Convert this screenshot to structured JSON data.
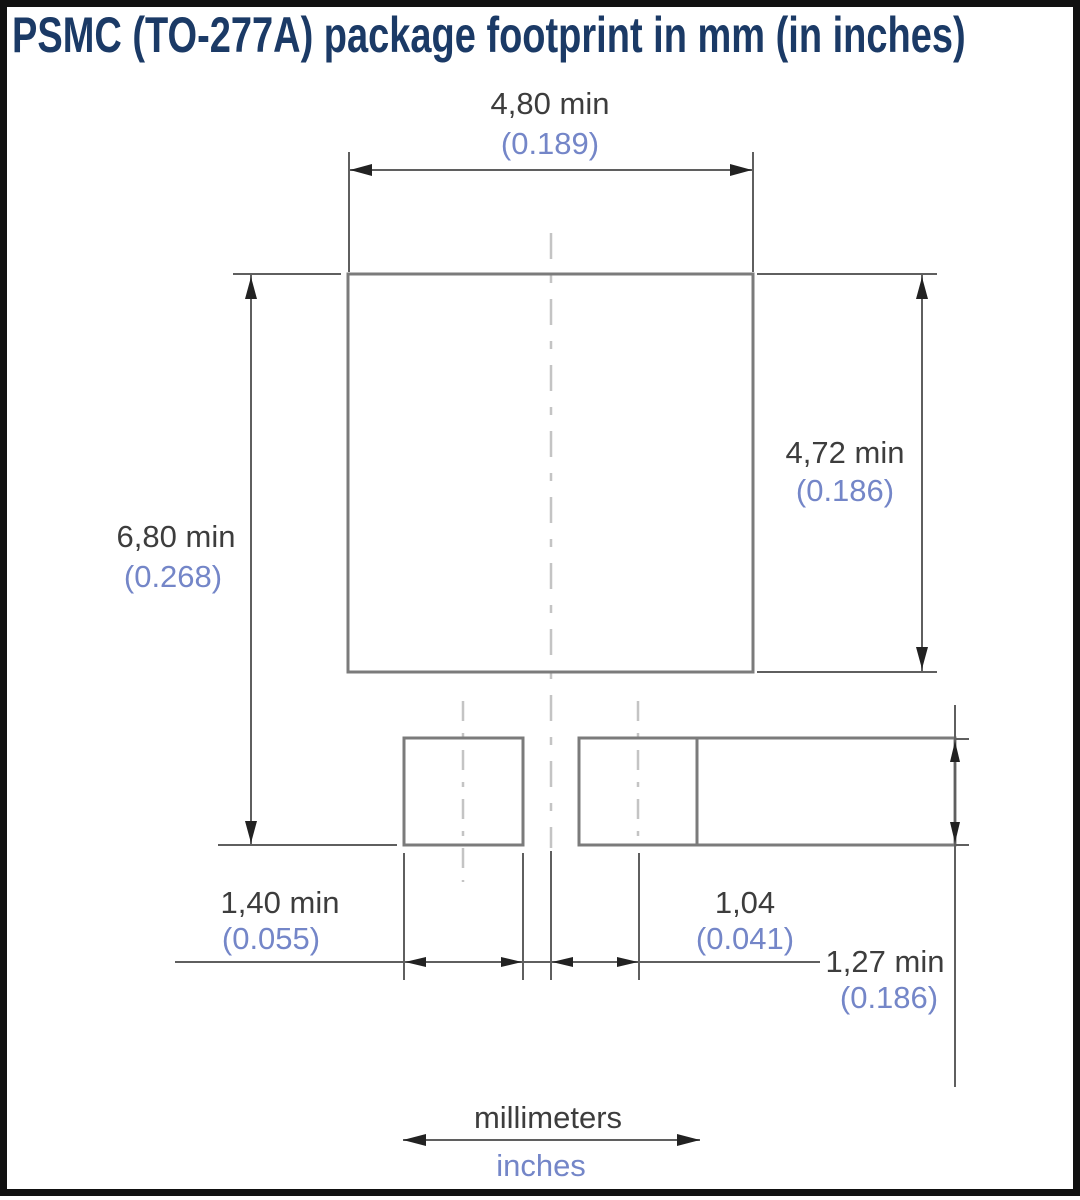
{
  "title": "PSMC (TO-277A) package footprint in mm (in inches)",
  "diagram": {
    "type": "package-footprint-drawing",
    "package": "PSMC (TO-277A)",
    "units_primary": "millimeters",
    "units_secondary": "inches (in parentheses)"
  },
  "dimensions": {
    "main_pad_width": {
      "mm": "4,80 min",
      "inches": "(0.189)"
    },
    "main_pad_height": {
      "mm": "4,72 min",
      "inches": "(0.186)"
    },
    "footprint_height": {
      "mm": "6,80 min",
      "inches": "(0.268)"
    },
    "small_pad_width": {
      "mm": "1,40 min",
      "inches": "(0.055)"
    },
    "pad_center_offset": {
      "mm": "1,04",
      "inches": "(0.041)"
    },
    "small_pad_height": {
      "mm": "1,27 min",
      "inches": "(0.186)"
    }
  },
  "legend": {
    "millimeters": "millimeters",
    "inches": "inches"
  },
  "colors": {
    "background": "#ffffff",
    "frame": "#111111",
    "title_text": "#1b3a66",
    "mm_text": "#3d3d3d",
    "inch_text": "#7486c8",
    "pad_outline": "#7b7b7b",
    "dimension_line": "#5f5f5f",
    "centerline": "#c4c4c4",
    "arrowhead": "#222222"
  }
}
